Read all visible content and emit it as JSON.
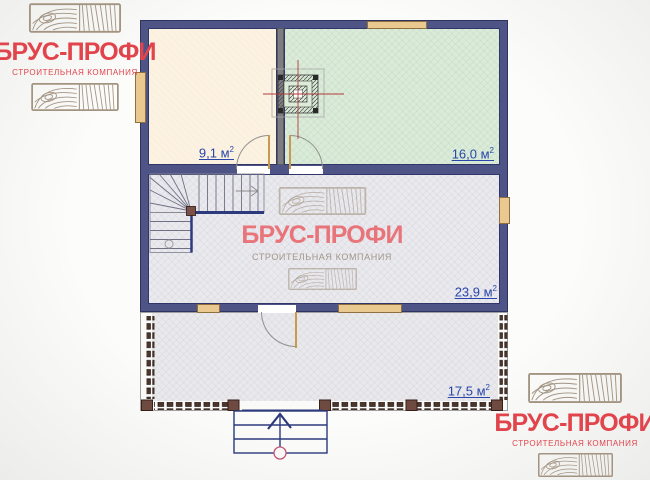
{
  "brand": {
    "name": "БРУС-ПРОФИ",
    "tagline": "СТРОИТЕЛЬНАЯ КОМПАНИЯ"
  },
  "plan": {
    "rooms": [
      {
        "name": "room-top-left",
        "area_label": "9,1 м",
        "area_sup": "2"
      },
      {
        "name": "room-top-right",
        "area_label": "16,0 м",
        "area_sup": "2"
      },
      {
        "name": "room-main",
        "area_label": "23,9 м",
        "area_sup": "2"
      },
      {
        "name": "terrace",
        "area_label": "17,5 м",
        "area_sup": "2"
      }
    ]
  },
  "icons": {
    "wood_texture": "wood-grain-stamp",
    "stove": "masonry-stove-plan-symbol",
    "entry_arrow": "up-arrow",
    "stair_arrow": "right-arrow"
  },
  "colors": {
    "wall": "#4e5486",
    "wall_outline": "#2e3360",
    "room_cream": "#fcf2e1",
    "room_green": "#daecd9",
    "room_gray": "#e9e9ee",
    "window_tan": "#e9c98f",
    "door_tan": "#c89a50",
    "partition_gray": "#7e7e82",
    "label_blue": "#2946ab",
    "brand_red": "#e2444c",
    "watermark_red": "#e9545a",
    "wood_stamp": "#a39482",
    "post_brown": "#6e4a40",
    "centerline_red": "#b23a3a",
    "stair_navy": "#2c3a7d"
  }
}
